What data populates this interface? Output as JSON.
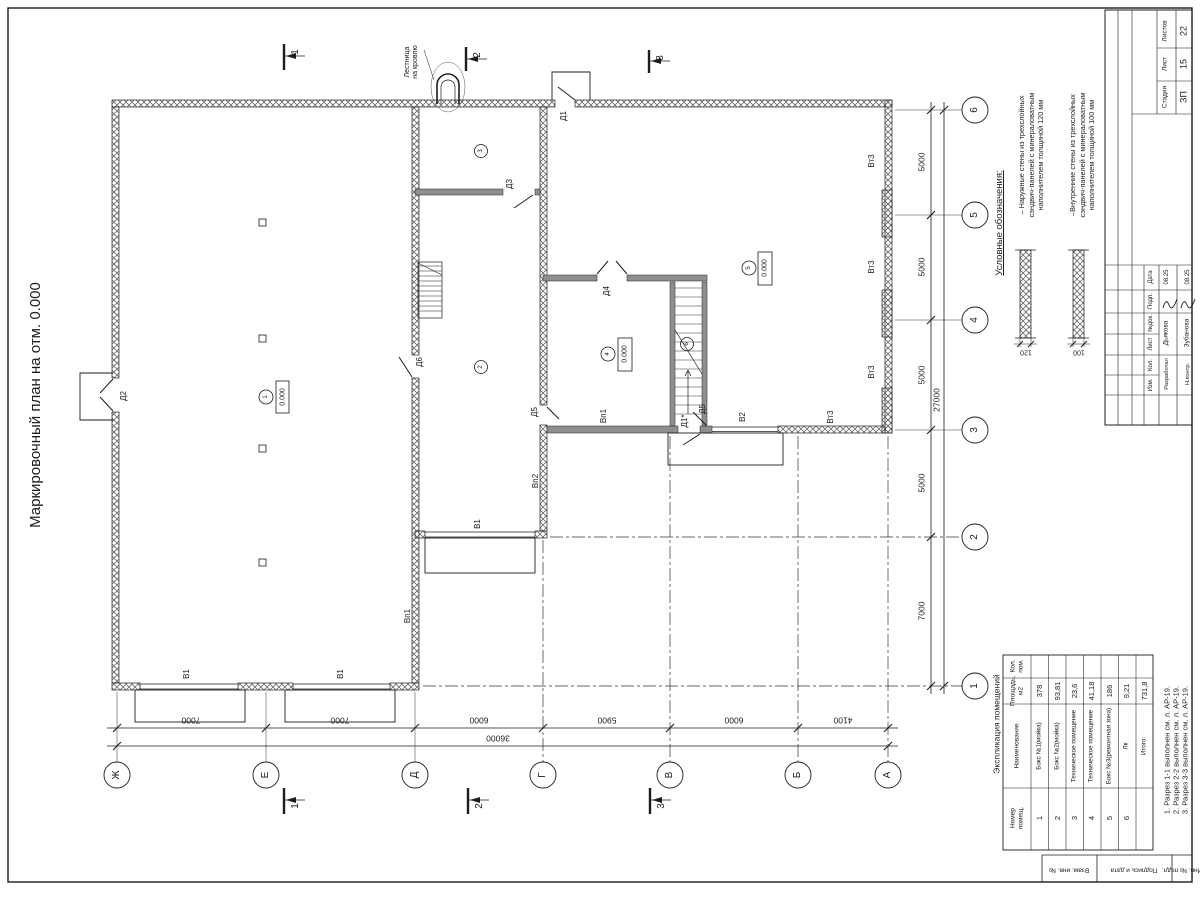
{
  "colors": {
    "ink": "#1c1c1c",
    "wall_fill": "#8f8f8f",
    "background": "#ffffff"
  },
  "room_table": {
    "title": "Экспликация помещений",
    "headers": [
      "Номер\nпомещ.",
      "Наименование",
      "Площадь,\nм2",
      "Кол.\nпом."
    ],
    "rows": [
      [
        "1",
        "Бокс №1(мойка)",
        "378",
        ""
      ],
      [
        "2",
        "Бокс №2(мойка)",
        "93,81",
        ""
      ],
      [
        "3",
        "Техническое помещение",
        "23,6",
        ""
      ],
      [
        "4",
        "Техническое помещение",
        "41,18",
        ""
      ],
      [
        "5",
        "Бокс №3(ремонтная зона)",
        "186",
        ""
      ],
      [
        "6",
        "Лк",
        "9,21",
        ""
      ],
      [
        "",
        "Итого:",
        "731,8",
        ""
      ]
    ]
  },
  "text_items": {
    "sheet": [
      {
        "name": "sheet-title",
        "text": "Маркировочный план на отм. 0.000",
        "x": 36,
        "y": 405,
        "fs": 15
      }
    ],
    "table": [
      {
        "name": "room-table-title",
        "text": "Экспликация помещений",
        "x": 997,
        "y": 724,
        "fs": 8.5
      }
    ],
    "plan": [
      {
        "name": "roof-ladder-label",
        "text": "Лестница\nна кровлю",
        "x": 412,
        "y": 62,
        "fs": 7,
        "lh": 8
      },
      {
        "name": "door-label-d1",
        "text": "Д1",
        "x": 564,
        "y": 116,
        "fs": 8
      },
      {
        "name": "door-label-d2",
        "text": "Д2",
        "x": 124,
        "y": 396,
        "fs": 8
      },
      {
        "name": "door-label-d3",
        "text": "Д3",
        "x": 510,
        "y": 184,
        "fs": 8
      },
      {
        "name": "door-label-d4",
        "text": "Д4",
        "x": 607,
        "y": 291,
        "fs": 8
      },
      {
        "name": "door-label-d5-1",
        "text": "Д5",
        "x": 535,
        "y": 412,
        "fs": 8
      },
      {
        "name": "door-label-d5-2",
        "text": "Д5",
        "x": 703,
        "y": 409,
        "fs": 8
      },
      {
        "name": "door-label-d6",
        "text": "Д6",
        "x": 420,
        "y": 362,
        "fs": 8
      },
      {
        "name": "door-label-d1s",
        "text": "Д1*",
        "x": 685,
        "y": 421,
        "fs": 8
      },
      {
        "name": "gate-label-v1-1",
        "text": "В1",
        "x": 187,
        "y": 674,
        "fs": 8
      },
      {
        "name": "gate-label-v1-2",
        "text": "В1",
        "x": 341,
        "y": 674,
        "fs": 8
      },
      {
        "name": "gate-label-v1-3",
        "text": "В1",
        "x": 478,
        "y": 524,
        "fs": 8
      },
      {
        "name": "gate-label-v2",
        "text": "В2",
        "x": 743,
        "y": 417,
        "fs": 8
      },
      {
        "name": "label-vp1-1",
        "text": "Вп1",
        "x": 408,
        "y": 616,
        "fs": 8
      },
      {
        "name": "label-vp1-2",
        "text": "Вп1",
        "x": 604,
        "y": 416,
        "fs": 8
      },
      {
        "name": "label-vp2",
        "text": "Вп2",
        "x": 536,
        "y": 481,
        "fs": 8
      },
      {
        "name": "label-vt3-1",
        "text": "Вт3",
        "x": 872,
        "y": 161,
        "fs": 8
      },
      {
        "name": "label-vt3-2",
        "text": "Вт3",
        "x": 872,
        "y": 267,
        "fs": 8
      },
      {
        "name": "label-vt3-3",
        "text": "Вт3",
        "x": 872,
        "y": 372,
        "fs": 8
      },
      {
        "name": "label-vt3-4",
        "text": "Вт3",
        "x": 831,
        "y": 417,
        "fs": 8
      },
      {
        "name": "room-tag-1",
        "text": "1",
        "x": 266,
        "y": 397,
        "fs": 6
      },
      {
        "name": "room-tag-2",
        "text": "2",
        "x": 481,
        "y": 367,
        "fs": 6
      },
      {
        "name": "room-tag-3",
        "text": "3",
        "x": 481,
        "y": 151,
        "fs": 6
      },
      {
        "name": "room-tag-4",
        "text": "4",
        "x": 608,
        "y": 354,
        "fs": 6
      },
      {
        "name": "room-tag-5",
        "text": "5",
        "x": 749,
        "y": 268,
        "fs": 6
      },
      {
        "name": "room-tag-6",
        "text": "6",
        "x": 687,
        "y": 344,
        "fs": 6
      },
      {
        "name": "elevation-mark-room1",
        "text": "0.000",
        "x": 282.5,
        "y": 397,
        "fs": 7
      },
      {
        "name": "elevation-mark-room4",
        "text": "0.000",
        "x": 625,
        "y": 354,
        "fs": 7
      },
      {
        "name": "elevation-mark-room5",
        "text": "0.000",
        "x": 765,
        "y": 268,
        "fs": 7
      },
      {
        "name": "section-label-1-top",
        "text": "1",
        "x": 296,
        "y": 52,
        "fs": 10
      },
      {
        "name": "section-label-2-top",
        "text": "2",
        "x": 478,
        "y": 55,
        "fs": 10
      },
      {
        "name": "section-label-3-top",
        "text": "3",
        "x": 661,
        "y": 58,
        "fs": 10
      },
      {
        "name": "section-label-1-bottom",
        "text": "1",
        "x": 296,
        "y": 806,
        "fs": 10
      },
      {
        "name": "section-label-2-bottom",
        "text": "2",
        "x": 480,
        "y": 806,
        "fs": 10
      },
      {
        "name": "section-label-3-bottom",
        "text": "3",
        "x": 662,
        "y": 806,
        "fs": 10
      }
    ],
    "dimensions": [
      {
        "name": "dim-bottom-1",
        "text": "7000",
        "x": 191,
        "y": 720,
        "fs": 8.5,
        "rot": 180
      },
      {
        "name": "dim-bottom-2",
        "text": "7000",
        "x": 340,
        "y": 720,
        "fs": 8.5,
        "rot": 180
      },
      {
        "name": "dim-bottom-3",
        "text": "6000",
        "x": 479,
        "y": 720,
        "fs": 8.5,
        "rot": 180
      },
      {
        "name": "dim-bottom-4",
        "text": "5900",
        "x": 607,
        "y": 720,
        "fs": 8.5,
        "rot": 180
      },
      {
        "name": "dim-bottom-5",
        "text": "6000",
        "x": 734,
        "y": 720,
        "fs": 8.5,
        "rot": 180
      },
      {
        "name": "dim-bottom-6",
        "text": "4100",
        "x": 843,
        "y": 720,
        "fs": 8.5,
        "rot": 180
      },
      {
        "name": "dim-bottom-total",
        "text": "36000",
        "x": 498,
        "y": 738,
        "fs": 8.5,
        "rot": 180
      },
      {
        "name": "dim-right-1",
        "text": "5000",
        "x": 922,
        "y": 162,
        "fs": 8.5
      },
      {
        "name": "dim-right-2",
        "text": "5000",
        "x": 922,
        "y": 267,
        "fs": 8.5
      },
      {
        "name": "dim-right-3",
        "text": "5000",
        "x": 922,
        "y": 375,
        "fs": 8.5
      },
      {
        "name": "dim-right-4",
        "text": "5000",
        "x": 922,
        "y": 483,
        "fs": 8.5
      },
      {
        "name": "dim-right-5",
        "text": "7000",
        "x": 922,
        "y": 611,
        "fs": 8.5
      },
      {
        "name": "dim-right-total",
        "text": "27000",
        "x": 937,
        "y": 400,
        "fs": 8.5
      }
    ],
    "grid": [
      {
        "name": "grid-col-zh",
        "text": "Ж",
        "x": 117,
        "y": 775,
        "fs": 10
      },
      {
        "name": "grid-col-e",
        "text": "Е",
        "x": 266,
        "y": 775,
        "fs": 10
      },
      {
        "name": "grid-col-d",
        "text": "Д",
        "x": 415,
        "y": 775,
        "fs": 10
      },
      {
        "name": "grid-col-g",
        "text": "Г",
        "x": 543,
        "y": 775,
        "fs": 10
      },
      {
        "name": "grid-col-v",
        "text": "В",
        "x": 670,
        "y": 775,
        "fs": 10
      },
      {
        "name": "grid-col-b",
        "text": "Б",
        "x": 798,
        "y": 775,
        "fs": 10
      },
      {
        "name": "grid-col-a",
        "text": "А",
        "x": 888,
        "y": 775,
        "fs": 10
      },
      {
        "name": "grid-row-6",
        "text": "6",
        "x": 975,
        "y": 110,
        "fs": 10
      },
      {
        "name": "grid-row-5",
        "text": "5",
        "x": 975,
        "y": 215,
        "fs": 10
      },
      {
        "name": "grid-row-4",
        "text": "4",
        "x": 975,
        "y": 320,
        "fs": 10
      },
      {
        "name": "grid-row-3",
        "text": "3",
        "x": 975,
        "y": 430,
        "fs": 10
      },
      {
        "name": "grid-row-2",
        "text": "2",
        "x": 975,
        "y": 537,
        "fs": 10
      },
      {
        "name": "grid-row-1",
        "text": "1",
        "x": 975,
        "y": 686,
        "fs": 10
      }
    ],
    "legend": [
      {
        "name": "legend-title",
        "text": "Условные обозначения:",
        "x": 1000,
        "y": 223,
        "fs": 9.5,
        "u": 1
      },
      {
        "name": "legend-item-exterior",
        "text": "– Наружные стены из трехслойных\nсэндвич-панелей с минераловатным\nнаполнителем толщиной 120 мм",
        "x": 1031,
        "y": 155,
        "fs": 7.3,
        "lh": 9.5
      },
      {
        "name": "legend-item-interior",
        "text": "–Внутренние стены из трехслойных\nсэндвич-панелей с минераловатным\nнаполнителем толщиной 100 мм",
        "x": 1082,
        "y": 155,
        "fs": 7.3,
        "lh": 9.5
      },
      {
        "name": "legend-dim-120",
        "text": "120",
        "x": 1026,
        "y": 352,
        "fs": 7,
        "rot": 180
      },
      {
        "name": "legend-dim-100",
        "text": "100",
        "x": 1079,
        "y": 352,
        "fs": 7,
        "rot": 180
      }
    ],
    "stamp": [
      {
        "name": "stamp-total-label",
        "text": "Листов",
        "x": 1166,
        "y": 31,
        "fs": 6.5
      },
      {
        "name": "stamp-total-value",
        "text": "22",
        "x": 1184,
        "y": 31,
        "fs": 9
      },
      {
        "name": "stamp-sheet-label",
        "text": "Лист",
        "x": 1166,
        "y": 64,
        "fs": 6.5
      },
      {
        "name": "stamp-sheet-value",
        "text": "15",
        "x": 1184,
        "y": 64,
        "fs": 9
      },
      {
        "name": "stamp-stage-label",
        "text": "Стадия",
        "x": 1166,
        "y": 97,
        "fs": 6.5
      },
      {
        "name": "stamp-stage-value",
        "text": "ЗП",
        "x": 1184,
        "y": 97,
        "fs": 9
      },
      {
        "name": "stamp-col-date",
        "text": "Дата",
        "x": 1151,
        "y": 277,
        "fs": 6
      },
      {
        "name": "stamp-col-sign",
        "text": "Подп.",
        "x": 1151,
        "y": 301,
        "fs": 6
      },
      {
        "name": "stamp-col-docnum",
        "text": "№док.",
        "x": 1151,
        "y": 323,
        "fs": 6
      },
      {
        "name": "stamp-col-sheet",
        "text": "Лист",
        "x": 1151,
        "y": 344,
        "fs": 6
      },
      {
        "name": "stamp-col-qty",
        "text": "Кол.",
        "x": 1151,
        "y": 365,
        "fs": 6
      },
      {
        "name": "stamp-col-change",
        "text": "Изм.",
        "x": 1151,
        "y": 385,
        "fs": 6
      },
      {
        "name": "stamp-role-developed",
        "text": "Разработал",
        "x": 1167,
        "y": 374,
        "fs": 5.8
      },
      {
        "name": "stamp-name-developed",
        "text": "Дьякова",
        "x": 1167,
        "y": 333,
        "fs": 6.5
      },
      {
        "name": "stamp-date-developed",
        "text": "08.25",
        "x": 1167,
        "y": 277,
        "fs": 6
      },
      {
        "name": "stamp-role-control",
        "text": "Н.контр.",
        "x": 1188,
        "y": 374,
        "fs": 5.8
      },
      {
        "name": "stamp-name-control",
        "text": "Зубанова",
        "x": 1188,
        "y": 333,
        "fs": 6.5
      },
      {
        "name": "stamp-date-control",
        "text": "08.25",
        "x": 1188,
        "y": 277,
        "fs": 6
      }
    ],
    "notes": [
      {
        "name": "section-notes",
        "text": "1. Разрез 1-1 выполнен см. л. АР-19.\n2. Разрез 2-2 выполнен см. л. АР-19.\n3. Разрез 3-3 выполнен см. л. АР-19.",
        "x": 1176,
        "y": 750,
        "fs": 7.5,
        "lh": 9
      }
    ],
    "frame": [
      {
        "name": "frame-cell-vzam",
        "text": "Взам. инв. №",
        "x": 1069,
        "y": 869,
        "fs": 6.5,
        "rot": 180
      },
      {
        "name": "frame-cell-podpis",
        "text": "Подпись и дата",
        "x": 1134,
        "y": 869,
        "fs": 6.5,
        "rot": 180
      },
      {
        "name": "frame-cell-inv",
        "text": "Инв. № подл.",
        "x": 1182,
        "y": 869,
        "fs": 6.5,
        "rot": 180
      }
    ]
  }
}
